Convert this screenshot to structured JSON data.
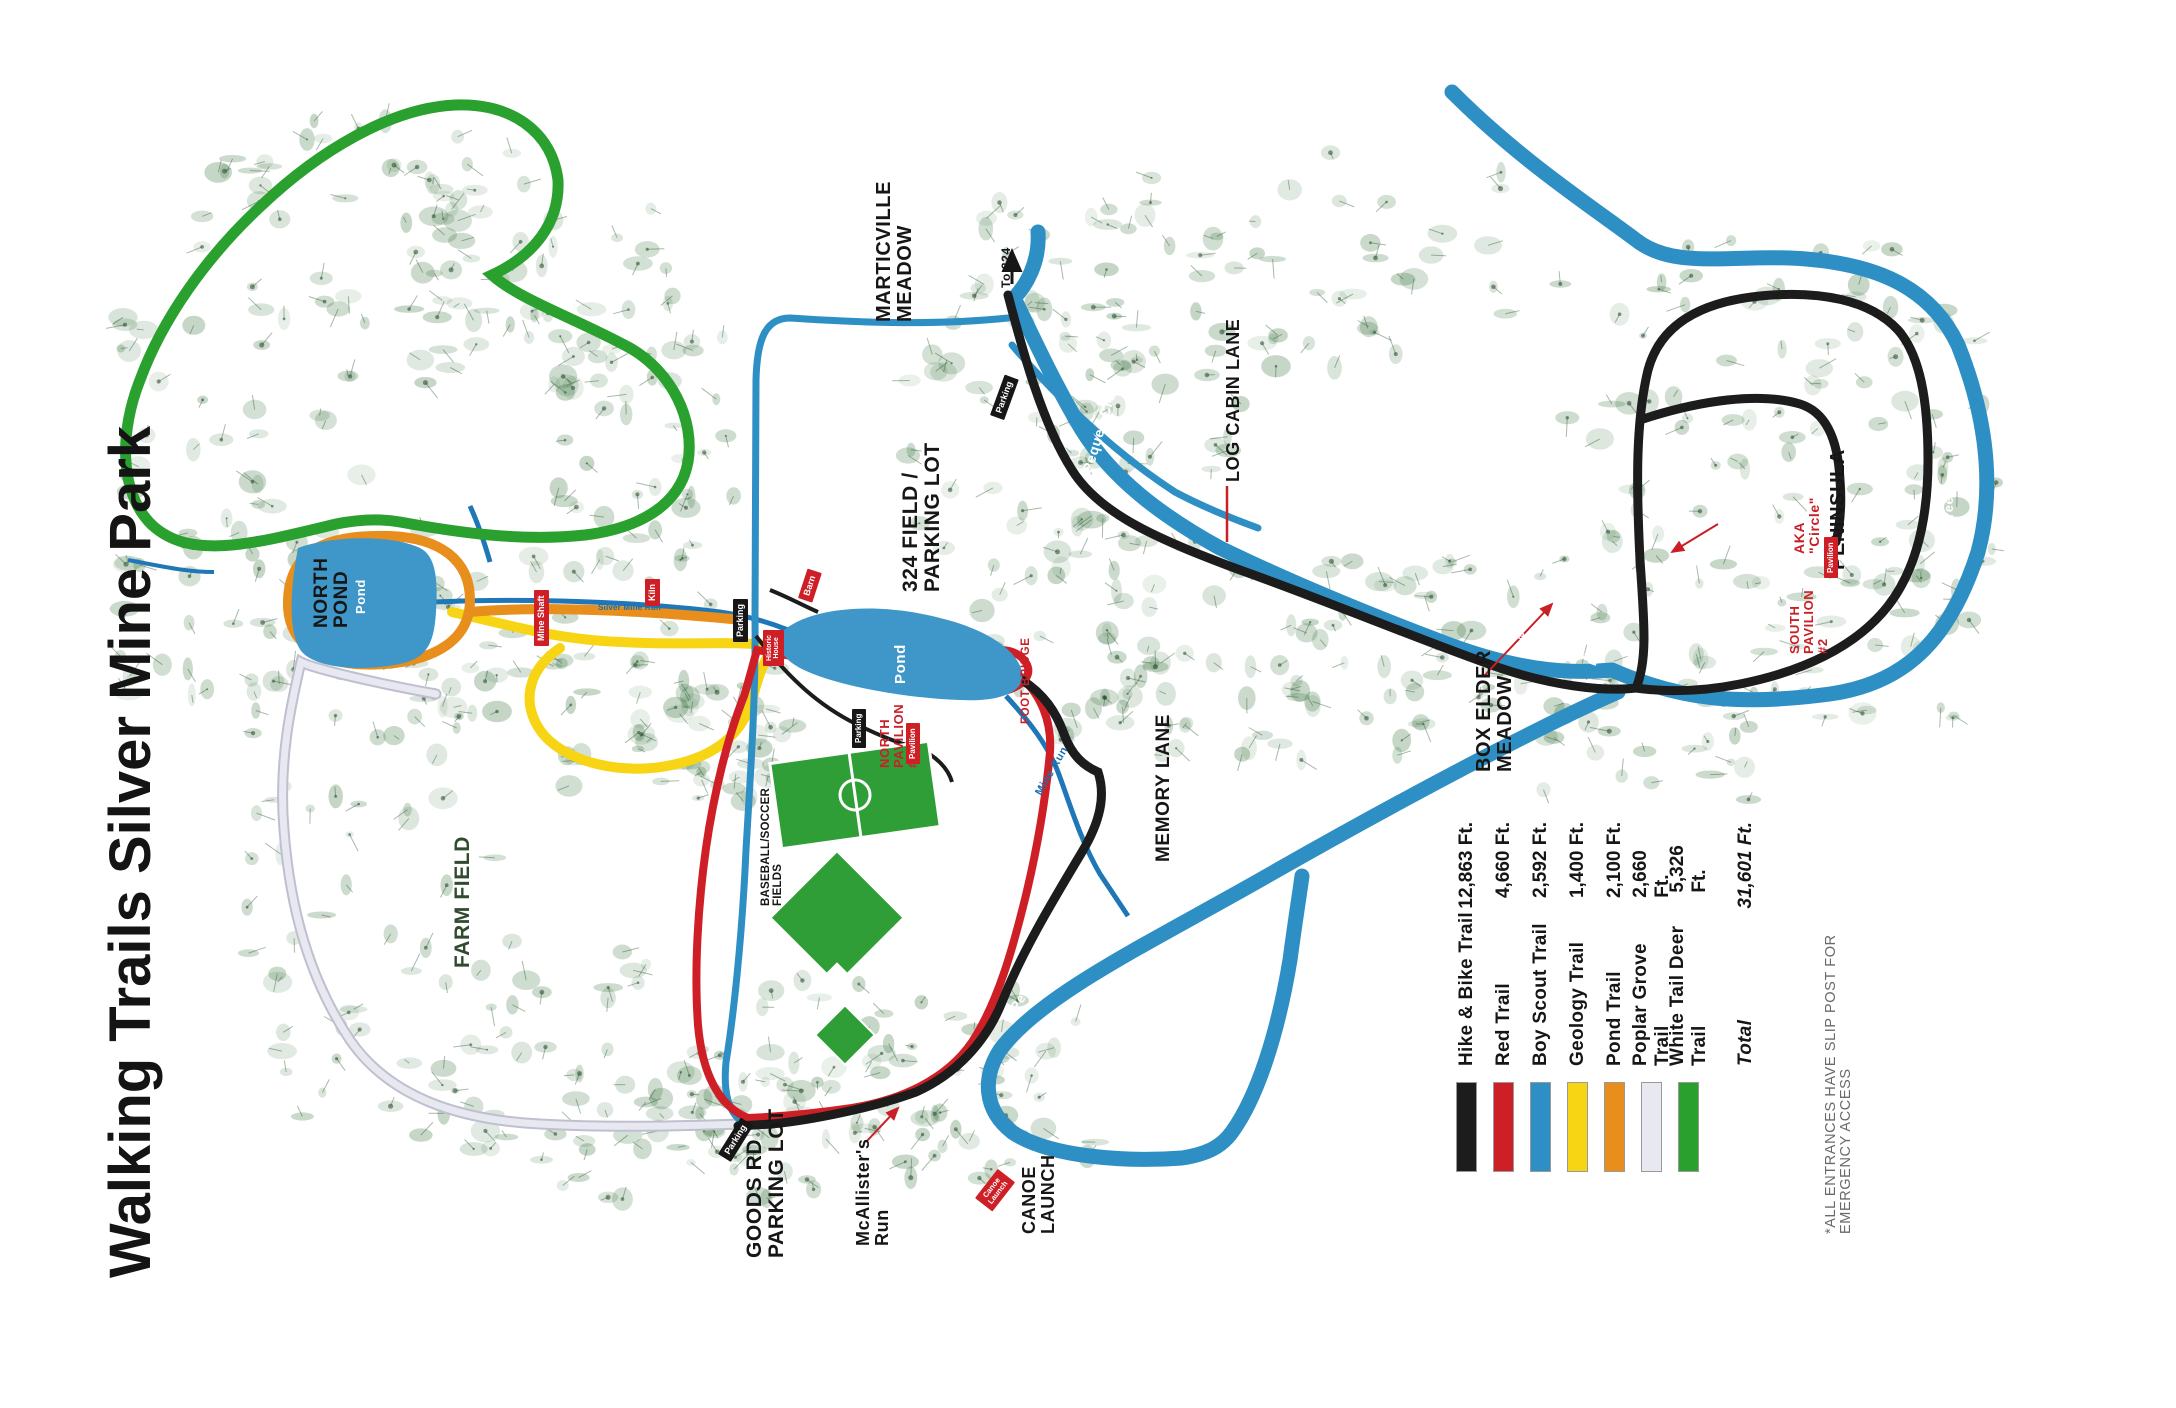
{
  "title": "Walking Trails Silver Mine Park",
  "legend": {
    "entries": [
      {
        "name": "Hike & Bike Trail",
        "distance": "12,863 Ft.",
        "color": "#1c1c1c"
      },
      {
        "name": "Red Trail",
        "distance": "4,660 Ft.",
        "color": "#cf1f26"
      },
      {
        "name": "Boy Scout Trail",
        "distance": "2,592 Ft.",
        "color": "#2e8fc4"
      },
      {
        "name": "Geology Trail",
        "distance": "1,400 Ft.",
        "color": "#f7d414"
      },
      {
        "name": "Pond Trail",
        "distance": "2,100 Ft.",
        "color": "#e78e1d"
      },
      {
        "name": "Poplar Grove Trail",
        "distance": "2,660 Ft.",
        "color": "#e8e8f0"
      },
      {
        "name": "White Tail Deer Trail",
        "distance": "5,326 Ft.",
        "color": "#2aa12e"
      }
    ],
    "total_label": "Total",
    "total_value": "31,601 Ft."
  },
  "labels": {
    "marticville": "MARTICVILLE\nMEADOW",
    "to324": "To 324",
    "field324": "324 FIELD /\nPARKING LOT",
    "logcabin": "LOG CABIN LANE",
    "peninsula": "PENINSULA",
    "aka": "AKA\n\"Circle\"",
    "south_pavilion": "SOUTH\nPAVILION\n#2",
    "boxelder": "BOX ELDER\nMEADOW",
    "memory": "MEMORY LANE",
    "farm": "FARM FIELD",
    "ballfields": "BASEBALL/SOCCER\nFIELDS",
    "goods": "GOODS RD\nPARKING LOT",
    "mcallister": "McAllister's\nRun",
    "canoe": "CANOE\nLAUNCH",
    "north_pond": "NORTH\nPOND",
    "pond": "Pond",
    "north_pavilion": "NORTH\nPAVILION\n#2",
    "footbridge": "FOOT BRIDGE",
    "pequea": "Pequea Creek",
    "mine_run": "Mine Run",
    "silver_mine_run": "Silver Mine Run",
    "note": "*ALL ENTRANCES HAVE SLIP POST FOR\nEMERGENCY ACCESS"
  },
  "markers": {
    "mine_shaft": "Mine Shaft",
    "kiln": "Kiln",
    "barn": "Barn",
    "historic_house": "Historic\nHouse",
    "pavilion": "Pavilion",
    "parking": "Parking",
    "canoe_launch": "Canoe\nLaunch"
  },
  "colors": {
    "hike_bike": "#1c1c1c",
    "red_trail": "#cf1f26",
    "boy_scout": "#2e8fc4",
    "geology": "#f7d414",
    "pond_trail": "#e78e1d",
    "poplar": "#e8e8f0",
    "poplar_casing": "#bfbfd0",
    "deer": "#2aa12e",
    "creek": "#2e8fc4",
    "pond_fill": "#3e97c8",
    "field_green": "#2f9e37",
    "stream": "#1f77b8"
  }
}
